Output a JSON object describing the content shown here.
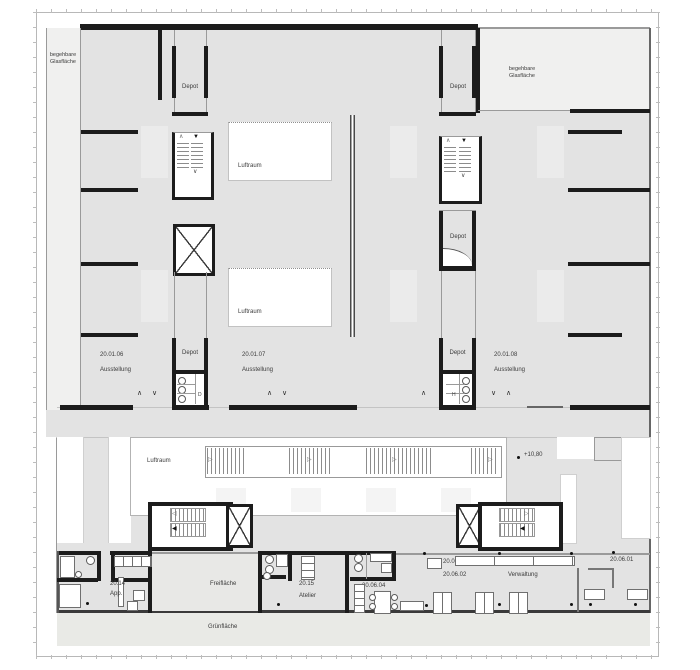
{
  "colors": {
    "wall": "#1c1c1c",
    "floor_gray": "#e3e3e3",
    "glass_light": "#f0f0ef",
    "void_white": "#ffffff",
    "green_band": "#e9eae6"
  },
  "labels": {
    "glass_area": "begehbare\nGlasfläche",
    "depot": "Depot",
    "luftraum": "Luftraum",
    "level_mark": "+10,80",
    "wc_women": "D",
    "wc_men": "H",
    "room_06_no": "20.01.06",
    "room_06_name": "Ausstellung",
    "room_07_no": "20.01.07",
    "room_07_name": "Ausstellung",
    "room_08_no": "20.01.08",
    "room_08_name": "Ausstellung",
    "app_no": "20.14",
    "app_name": "App.",
    "freiflaeche": "Freifläche",
    "atelier_no": "20.15",
    "atelier_name": "Atelier",
    "r0604": "20.06.04",
    "r0603": "20.06.03",
    "r0602": "20.06.02",
    "r0601": "20.06.01",
    "verwaltung": "Verwaltung",
    "gruenflaeche": "Grünfläche"
  },
  "markers": {
    "chevron_up": "∧",
    "chevron_down": "∨",
    "escalator_arrow": "▷",
    "stair_up_arrow": "∧",
    "stair_down_arrow": "▼",
    "stair_left_arrow": "◀",
    "stair_right_arrow": "▶",
    "stair_outline_left": "◁",
    "stair_outline_right": "▷"
  }
}
